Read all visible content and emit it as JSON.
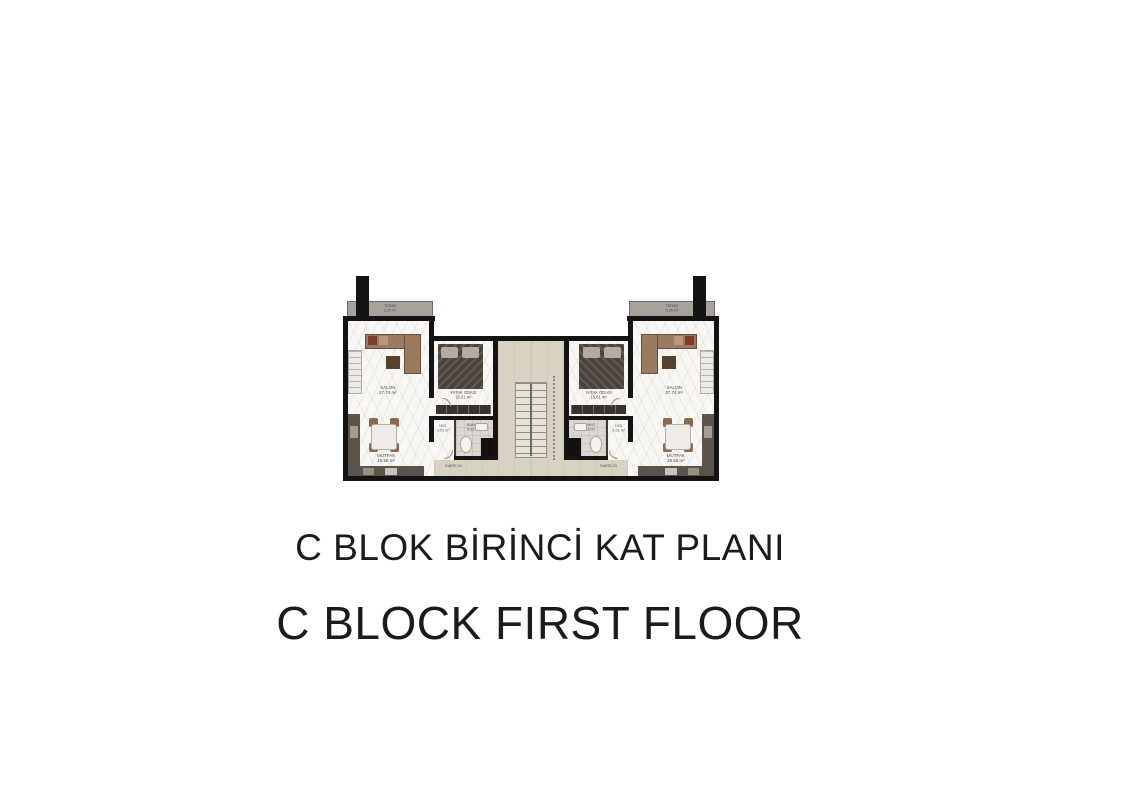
{
  "titles": {
    "turkish": "C BLOK BİRİNCİ KAT PLANI",
    "english": "C BLOCK FIRST FLOOR"
  },
  "plan": {
    "units": [
      {
        "id": "DAIRE-24",
        "rooms": {
          "teras": {
            "name": "TERAS",
            "area": "3.25 m²"
          },
          "salon": {
            "name": "SALON",
            "area": "27.74 m²"
          },
          "yatak": {
            "name": "YATAK ODASI",
            "area": "15.61 m²"
          },
          "hol": {
            "name": "HOL",
            "area": "2.01 m²"
          },
          "banyo": {
            "name": "BANYO",
            "area": "5.32 m²"
          },
          "mutfak": {
            "name": "MUTFAK",
            "area": "18.56 m²"
          }
        }
      },
      {
        "id": "DAIRE-23",
        "rooms": {
          "teras": {
            "name": "TERAS",
            "area": "3.25 m²"
          },
          "salon": {
            "name": "SALON",
            "area": "27.74 m²"
          },
          "yatak": {
            "name": "YATAK ODASI",
            "area": "15.61 m²"
          },
          "hol": {
            "name": "HOL",
            "area": "2.01 m²"
          },
          "banyo": {
            "name": "BANYO",
            "area": "5.32 m²"
          },
          "mutfak": {
            "name": "MUTFAK",
            "area": "18.56 m²"
          }
        }
      }
    ]
  },
  "colors": {
    "wall": "#141414",
    "hall_floor": "#d8d2c3",
    "terrace": "#a7a29a",
    "wood": "#9a7b5f"
  }
}
